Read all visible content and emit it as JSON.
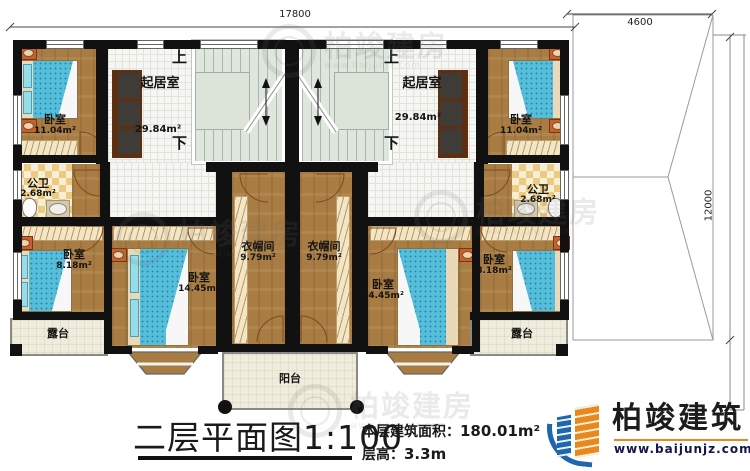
{
  "dimensions": {
    "top_width": "17800",
    "annex_width": "4600",
    "annex_depth": "12000"
  },
  "stairs": {
    "up": "上",
    "down": "下"
  },
  "rooms": {
    "living_left": {
      "name": "起居室",
      "area": "29.84m²"
    },
    "living_right": {
      "name": "起居室",
      "area": "29.84m²"
    },
    "bedroom_top_left": {
      "name": "卧室",
      "area": "11.04m²"
    },
    "bedroom_top_right": {
      "name": "卧室",
      "area": "11.04m²"
    },
    "bath_left": {
      "name": "公卫",
      "area": "2.68m²"
    },
    "bath_right": {
      "name": "公卫",
      "area": "2.68m²"
    },
    "bedroom_small_left": {
      "name": "卧室",
      "area": "8.18m²"
    },
    "bedroom_small_right": {
      "name": "卧室",
      "area": "8.18m²"
    },
    "bedroom_large_left": {
      "name": "卧室",
      "area": "14.45m²"
    },
    "bedroom_large_right": {
      "name": "卧室",
      "area": "14.45m²"
    },
    "closet_left": {
      "name": "衣帽间",
      "area": "9.79m²"
    },
    "closet_right": {
      "name": "衣帽间",
      "area": "9.79m²"
    },
    "terrace_left": {
      "name": "露台"
    },
    "terrace_right": {
      "name": "露台"
    },
    "balcony": {
      "name": "阳台"
    }
  },
  "title_block": {
    "title": "二层平面图",
    "scale": "1:100",
    "area_label": "本层建筑面积：",
    "area_value": "180.01m²",
    "floor_height_label": "层高：",
    "floor_height_value": "3.3m"
  },
  "brand": {
    "name": "柏竣建筑",
    "website": "www.baijunjz.com"
  },
  "watermark": {
    "text": "柏竣建房",
    "subtext": "www.baijunjz.com"
  },
  "colors": {
    "wall": "#111111",
    "wood": "#a87c42",
    "tile": "#f6f6f3",
    "bed_blue": "#55bedb",
    "brand_blue": "#1f66ad",
    "brand_orange": "#e8891d"
  }
}
